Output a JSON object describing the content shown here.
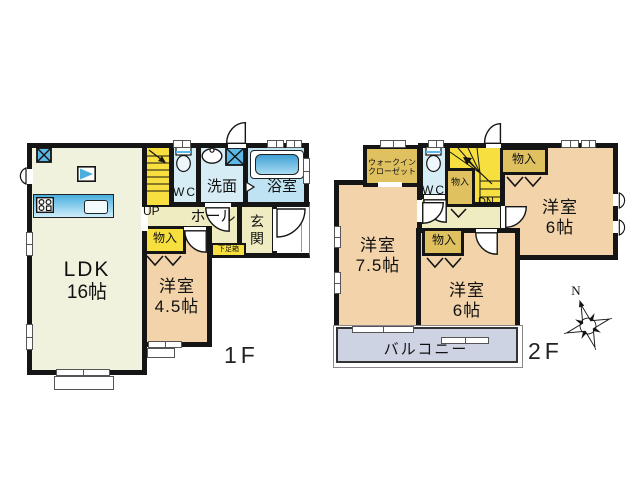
{
  "floor1": {
    "label": "1F",
    "rooms": {
      "ldk": {
        "label": "LDK",
        "size": "16帖"
      },
      "bedroom45": {
        "label": "洋室",
        "size": "4.5帖"
      },
      "wc": {
        "label": "WC"
      },
      "washroom": {
        "label": "洗面"
      },
      "bathroom": {
        "label": "浴室"
      },
      "hall": {
        "label": "ホール"
      },
      "entrance": {
        "label": "玄関"
      },
      "stairs": {
        "label": "UP"
      },
      "closet": {
        "label": "物入"
      },
      "shoe_box": {
        "label": "下足箱"
      }
    }
  },
  "floor2": {
    "label": "2F",
    "rooms": {
      "walk_in_closet": {
        "label_line1": "ウォークイン",
        "label_line2": "クローゼット"
      },
      "wc": {
        "label": "WC"
      },
      "stairs": {
        "label": "DN"
      },
      "closet_top": {
        "label": "物入"
      },
      "closet_stair": {
        "label": "物入"
      },
      "closet_mid": {
        "label": "物入"
      },
      "bedroom75": {
        "label": "洋室",
        "size": "7.5帖"
      },
      "bedroom6_east": {
        "label": "洋室",
        "size": "6帖"
      },
      "bedroom6_south": {
        "label": "洋室",
        "size": "6帖"
      },
      "balcony": {
        "label": "バルコニー"
      }
    }
  },
  "compass": {
    "north_label": "N"
  },
  "icons": {
    "refrigerator": "x-square-icon",
    "washing_machine": "x-square-icon",
    "tv_board": "triangle-square-icon",
    "stove": "stove-icon",
    "kitchen_sink": "sink-icon",
    "toilet": "toilet-icon",
    "wash_basin": "basin-icon",
    "bathtub": "bathtub-icon",
    "compass": "compass-rose-icon"
  },
  "colors": {
    "wall": "#151515",
    "ldk": "#f1f2de",
    "hall": "#f0ecc2",
    "stairs_yellow": "#f6df3e",
    "closet_mustard": "#e0c160",
    "bedroom_peach": "#f3d3a9",
    "sanitary_blue": "#d7edf6",
    "bath_blue": "#bfe3f2",
    "balcony": "#ced3e4",
    "fixture_blue": "#52b1e0"
  }
}
